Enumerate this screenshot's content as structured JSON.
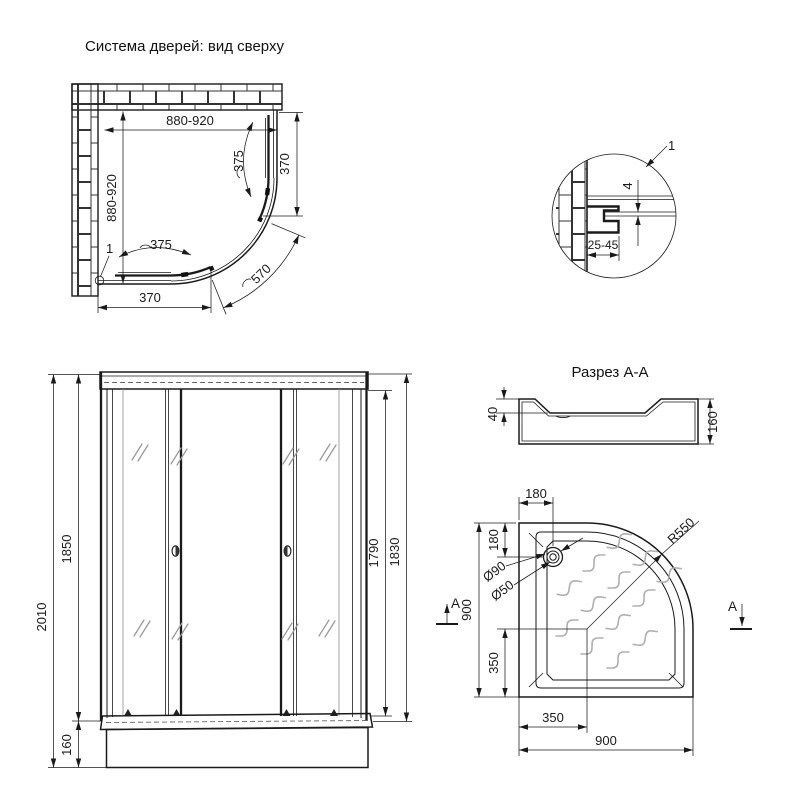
{
  "plan_view": {
    "title": "Система дверей: вид сверху",
    "dim_width": "880-920",
    "dim_depth": "880-920",
    "dim_segment_right": "370",
    "dim_segment_bottom": "370",
    "dim_door_right": "375",
    "dim_door_bottom": "375",
    "dim_opening_arc": "570",
    "callout": "1"
  },
  "detail_view": {
    "callout": "1",
    "dim_glass_gap": "4",
    "dim_adjust_range": "25-45"
  },
  "section_view": {
    "title": "Разрез А-А",
    "dim_rim_depth": "40",
    "dim_total_height": "160"
  },
  "front_view": {
    "dim_total_height": "2010",
    "dim_cabin_height": "1850",
    "dim_tray_height": "160",
    "dim_door_height": "1790",
    "dim_frame_height": "1830"
  },
  "tray_view": {
    "dim_drain_offset_x": "180",
    "dim_drain_offset_y": "180",
    "dim_drain_outer": "Ø90",
    "dim_drain_inner": "Ø50",
    "dim_radius": "R550",
    "dim_width": "900",
    "dim_depth": "900",
    "dim_center_from_left": "350",
    "dim_center_from_bottom": "350",
    "section_marker": "А"
  }
}
